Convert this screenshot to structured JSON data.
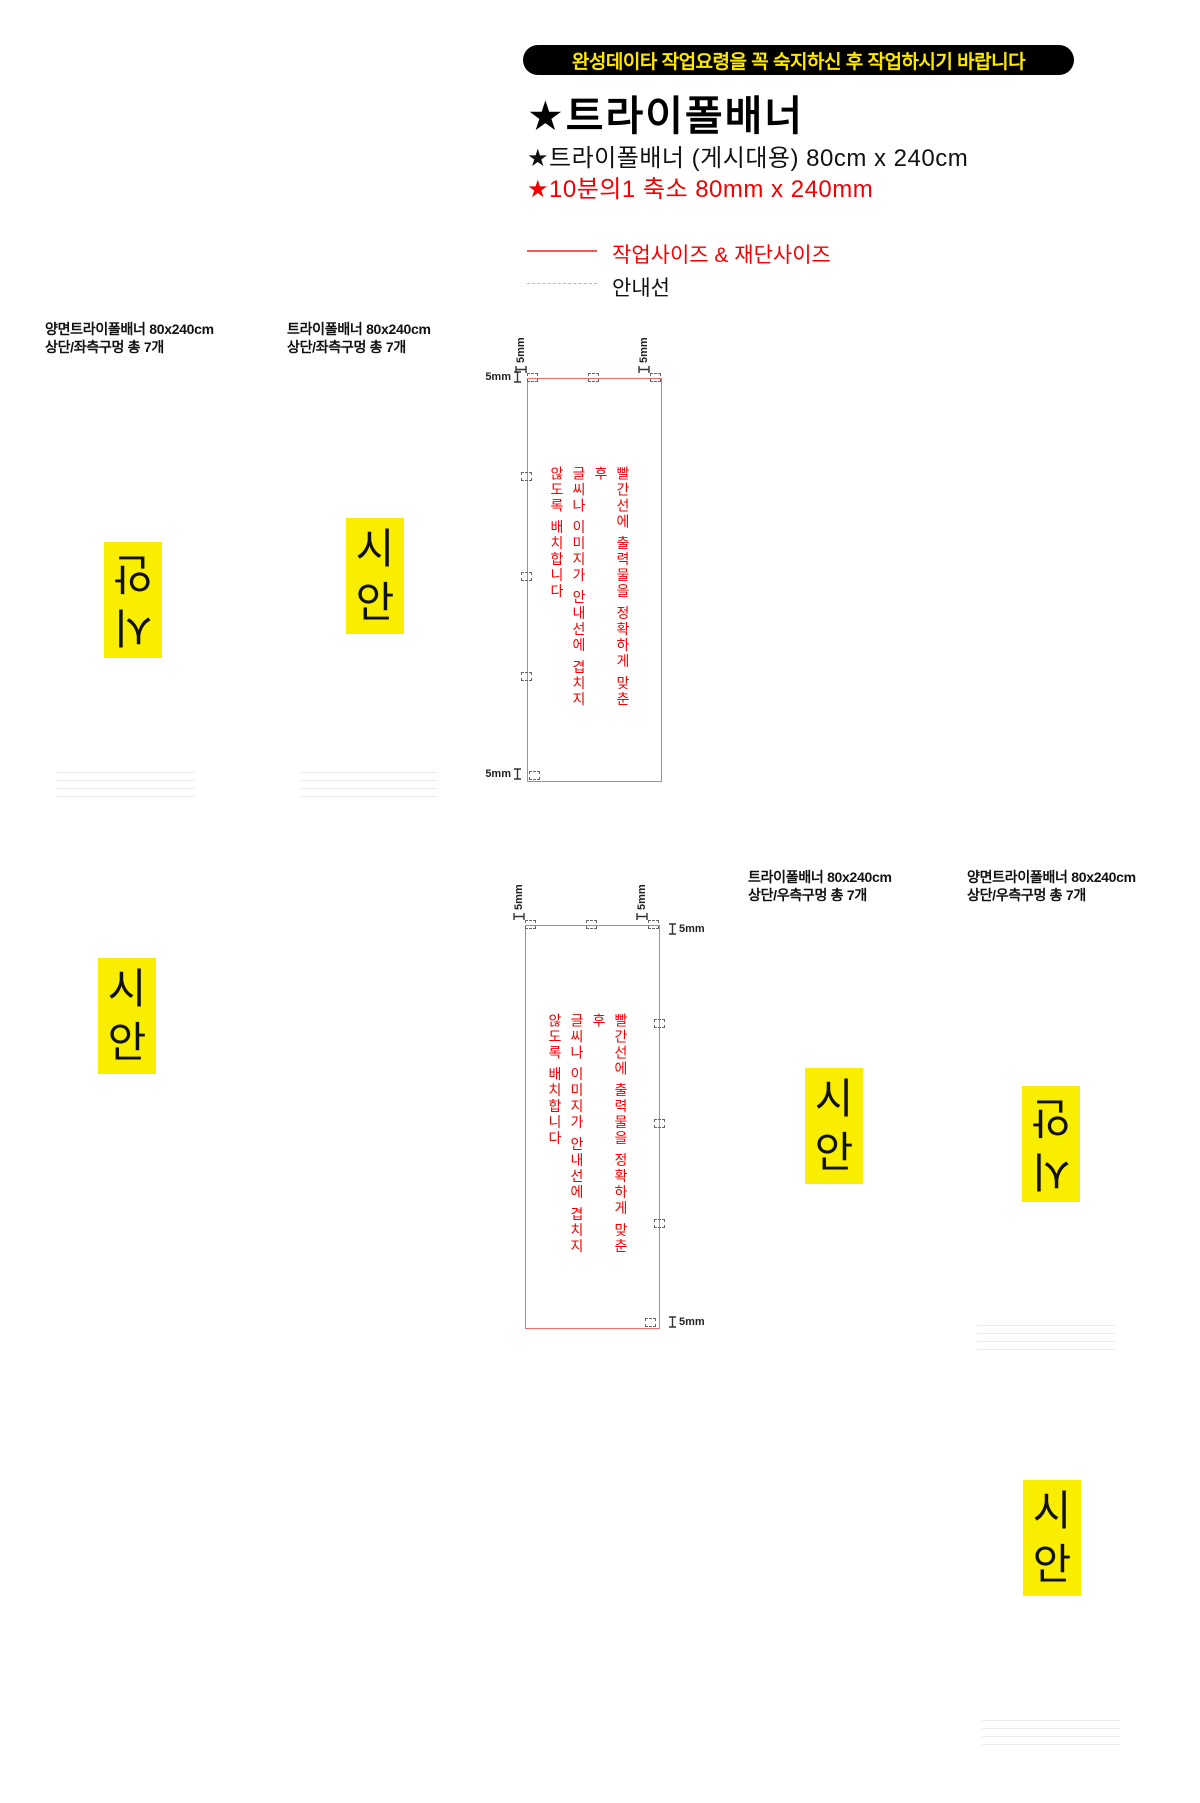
{
  "notice": {
    "text": "완성데이타 작업요령을 꼭 숙지하신 후 작업하시기 바랍니다"
  },
  "header": {
    "title": "★트라이폴배너",
    "subtitle": "★트라이폴배너 (게시대용) 80cm x 240cm",
    "scale_note": "★10분의1 축소 80mm x 240mm"
  },
  "legend": {
    "work_size_label": "작업사이즈 & 재단사이즈",
    "guide_label": "안내선"
  },
  "labels": {
    "left_double_line1": "양면트라이폴배너 80x240cm",
    "left_double_line2": "상단/좌측구멍 총 7개",
    "left_single_line1": "트라이폴배너 80x240cm",
    "left_single_line2": "상단/좌측구멍 총 7개",
    "right_single_line1": "트라이폴배너 80x240cm",
    "right_single_line2": "상단/우측구멍 총 7개",
    "right_double_line1": "양면트라이폴배너 80x240cm",
    "right_double_line2": "상단/우측구멍 총 7개"
  },
  "template": {
    "dim": "5mm",
    "instruction": "빨간선에 출력물을 정확하게 맞춘후\n글씨나 이미지가 안내선에 겹치지\n않도록 배치합니다"
  },
  "draft": {
    "label": "시\n안"
  },
  "colors": {
    "accent_red": "#f40000",
    "template_border_red": "#f56a6a",
    "draft_yellow": "#f9ed00",
    "notice_yellow": "#ffe800",
    "notice_bg": "#000000"
  }
}
